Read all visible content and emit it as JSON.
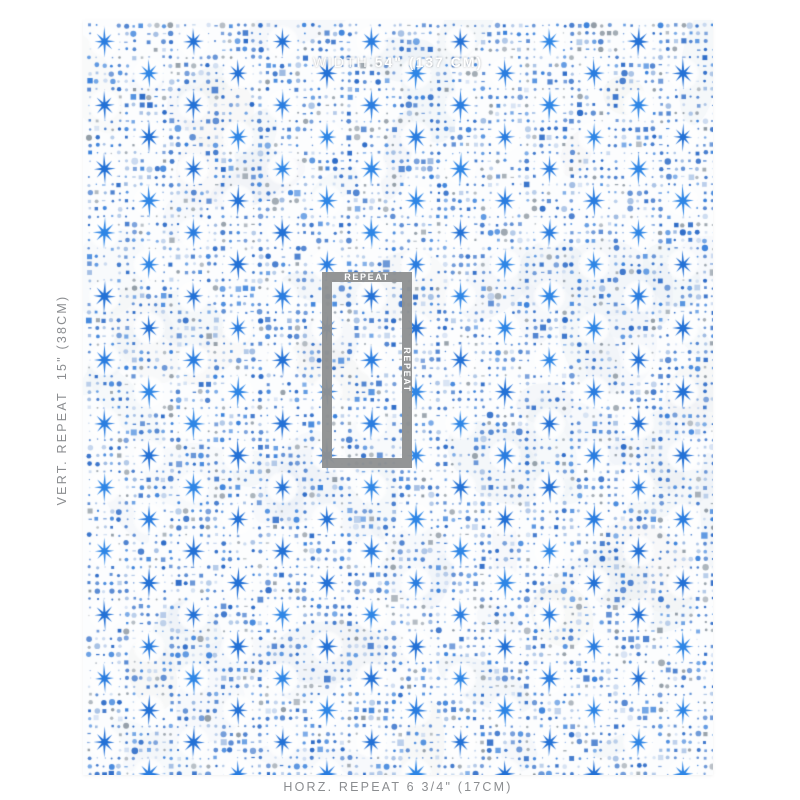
{
  "swatch": {
    "annotations": {
      "width_bar": {
        "prefix": "WIDTH",
        "value": "54\" (137 CM)"
      },
      "vert_repeat_label": "VERT. REPEAT  15\" (38CM)",
      "horz_repeat_label": "HORZ. REPEAT 6 3/4\" (17CM)",
      "repeat_box": {
        "top_label": "REPEAT",
        "side_label": "REPEAT"
      }
    },
    "colors": {
      "annotation_gray": "#8f9192",
      "label_text_gray": "#8b8d90",
      "label_white": "#ffffff",
      "fabric_bg": "#fcfdfe",
      "fabric_tint": "#e7edf4",
      "star_blues": [
        "#2a7de0",
        "#2e86e6",
        "#2371d6"
      ],
      "dot_colors": [
        "#2e6cc8",
        "#3b82dc",
        "#9fbbe2",
        "#c5d6ee",
        "#8f9aa4"
      ],
      "dot_weights": [
        0.45,
        0.2,
        0.15,
        0.08,
        0.12
      ]
    },
    "pattern": {
      "canvas_w": 630,
      "canvas_h": 755,
      "row_origin_y": 21.5,
      "row_step": 31.85,
      "rows": 24,
      "col_step": 89,
      "x_origin_even": 21.5,
      "x_origin_odd": 66,
      "star_r_vert": 14.6,
      "star_r_horiz": 10.6,
      "star_r_diag": 10.8,
      "star_r_inner": 3.1,
      "halo_radius": 9.5,
      "dot_grid_x0": 6.67,
      "dot_grid_dx": 7.4167,
      "dot_grid_y0": 5.58,
      "dot_grid_dy": 7.9625,
      "seed": 1337
    }
  }
}
